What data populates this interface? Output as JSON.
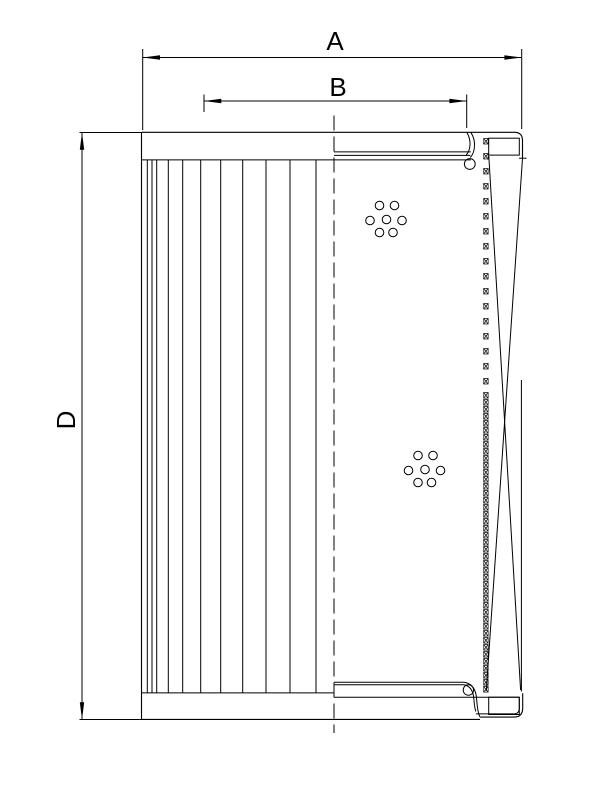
{
  "drawing": {
    "type": "technical-drawing",
    "subject": "filter-element-half-section",
    "background": "#ffffff",
    "line_color": "#000000",
    "labels": {
      "outer_width": "A",
      "inner_width": "B",
      "height": "D"
    }
  },
  "geometry": {
    "pleat_lines_x": [
      147.3,
      152,
      156.7,
      168.3,
      182.7,
      200.7,
      220.7,
      242.7,
      266,
      290,
      316
    ],
    "pleat_top_y": 159.9,
    "pleat_bottom_y": 692.9,
    "hole_clusters": [
      {
        "cx": 386.5,
        "cy": 219.5
      },
      {
        "cx": 425.0,
        "cy": 469.5
      }
    ],
    "hole_offsets": [
      [
        -7,
        -14
      ],
      [
        8,
        -14
      ],
      [
        -16.5,
        1
      ],
      [
        0,
        0
      ],
      [
        15.5,
        1
      ],
      [
        -7,
        13
      ],
      [
        6.5,
        13
      ]
    ],
    "hole_radius": 4.3
  }
}
